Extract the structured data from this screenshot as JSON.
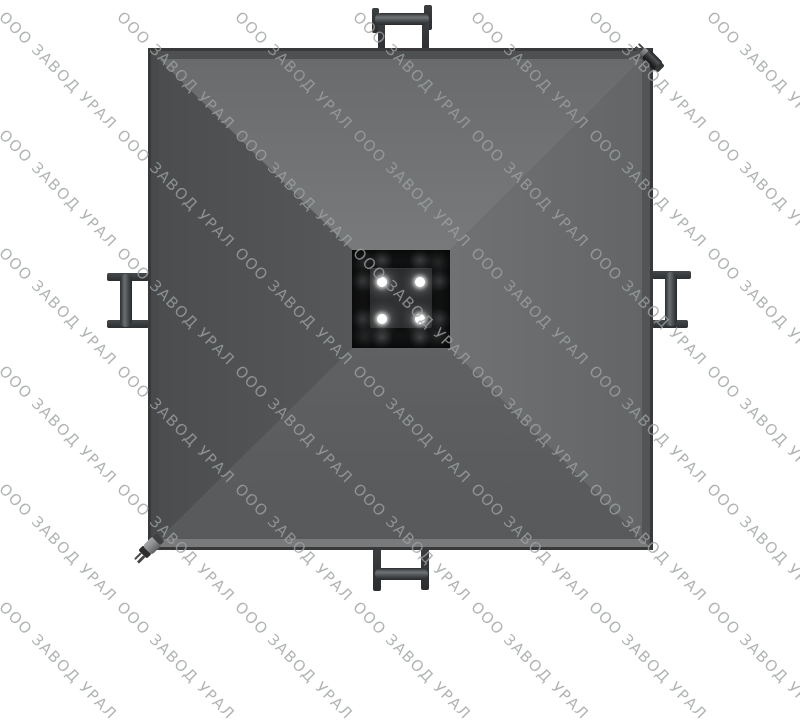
{
  "page": {
    "background": "#ffffff"
  },
  "watermark": {
    "text": "ООО ЗАВОД УРАЛ",
    "color": "rgba(158,161,163,0.8)",
    "grid": {
      "columns": 7,
      "rows": 6,
      "origin_x": 8,
      "origin_y": 8,
      "step_x": 118,
      "step_y": 118,
      "rotation_deg": 45
    }
  },
  "product": {
    "counts": {
      "bolts": 4,
      "handles": 4,
      "corner_pins": 2
    },
    "colors": {
      "rim": "#39393a",
      "face_top": "#8f9192",
      "face_right": "#7e8082",
      "face_bottom": "#6e7072",
      "face_left": "#595b5c",
      "socket": "#161718",
      "socket_plate": "#2e2f30",
      "bolt": "#ffffff",
      "handle": "#34373a"
    }
  }
}
